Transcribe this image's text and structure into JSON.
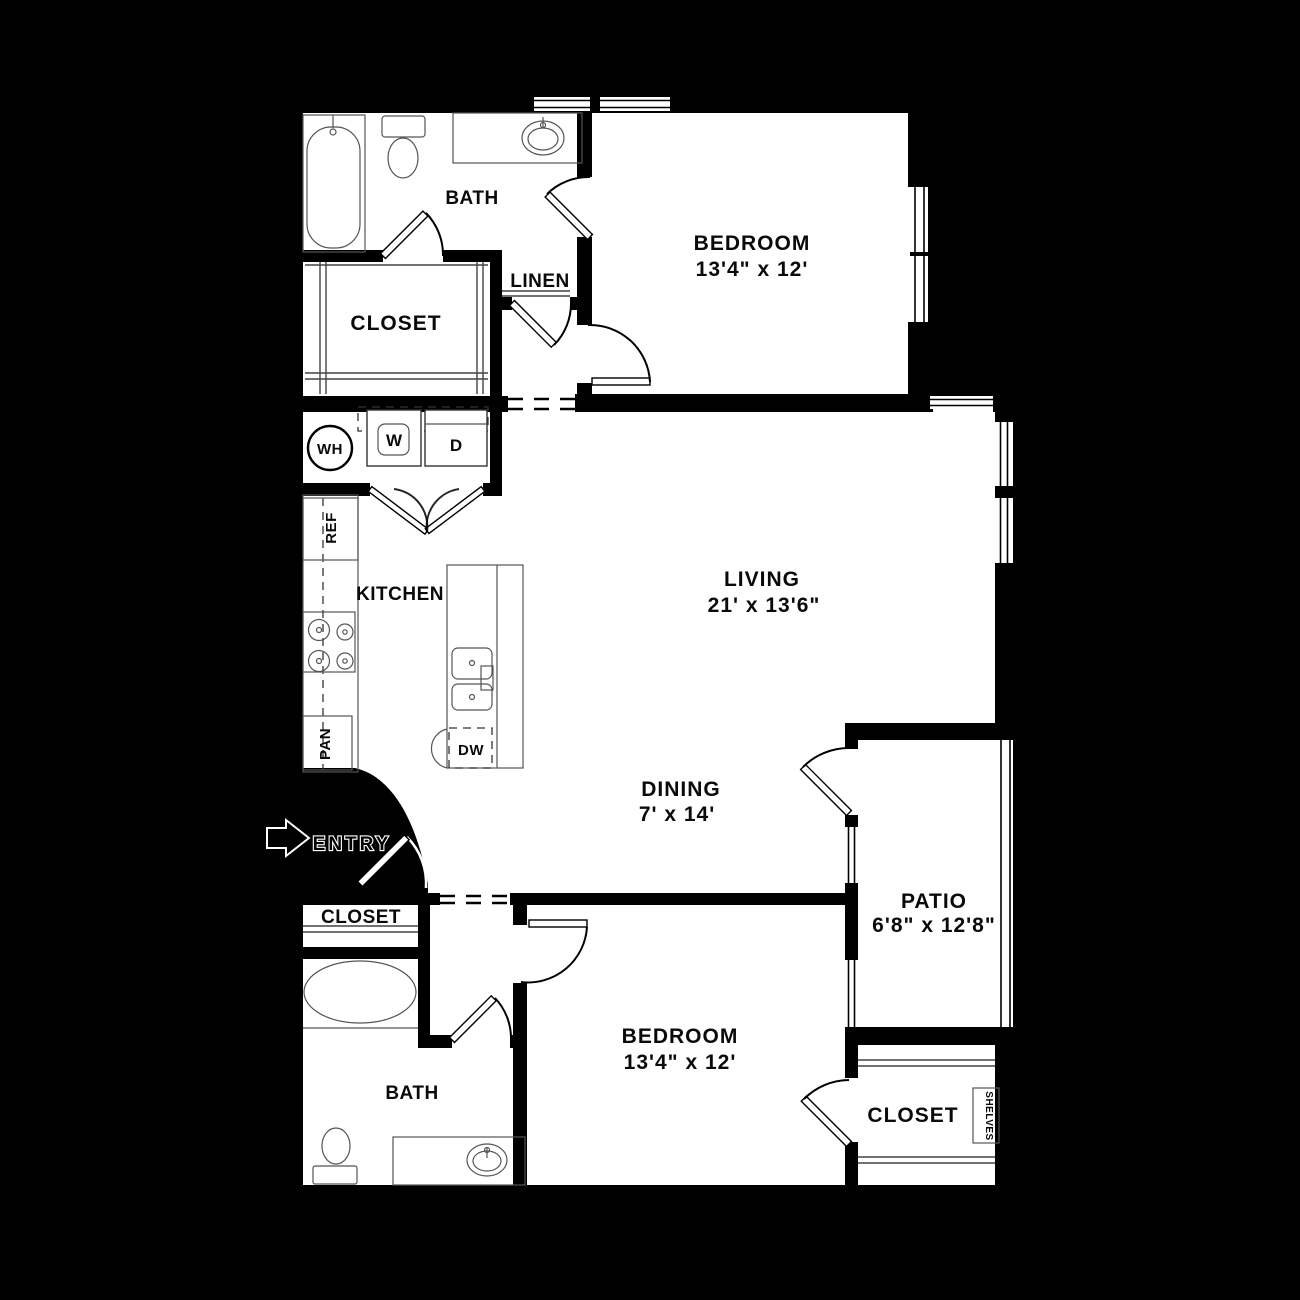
{
  "colors": {
    "background": "#000000",
    "walls": "#000000",
    "floor": "#ffffff",
    "text": "#0a0a0a"
  },
  "rooms": {
    "bedroom_top": {
      "label": "BEDROOM",
      "dimensions": "13'4\" x 12'"
    },
    "bedroom_bottom": {
      "label": "BEDROOM",
      "dimensions": "13'4\" x 12'"
    },
    "living": {
      "label": "LIVING",
      "dimensions": "21' x 13'6\""
    },
    "dining": {
      "label": "DINING",
      "dimensions": "7' x 14'"
    },
    "patio": {
      "label": "PATIO",
      "dimensions": "6'8\" x 12'8\""
    },
    "kitchen": {
      "label": "KITCHEN"
    },
    "bath_top": {
      "label": "BATH"
    },
    "bath_bottom": {
      "label": "BATH"
    },
    "closet_top": {
      "label": "CLOSET"
    },
    "closet_entry": {
      "label": "CLOSET"
    },
    "closet_bottom": {
      "label": "CLOSET"
    },
    "linen": {
      "label": "LINEN"
    },
    "entry": {
      "label": "ENTRY"
    }
  },
  "fixtures": {
    "water_heater": "WH",
    "washer": "W",
    "dryer": "D",
    "refrigerator": "REF",
    "pantry": "PAN",
    "dishwasher": "DW",
    "shelves": "SHELVES"
  }
}
